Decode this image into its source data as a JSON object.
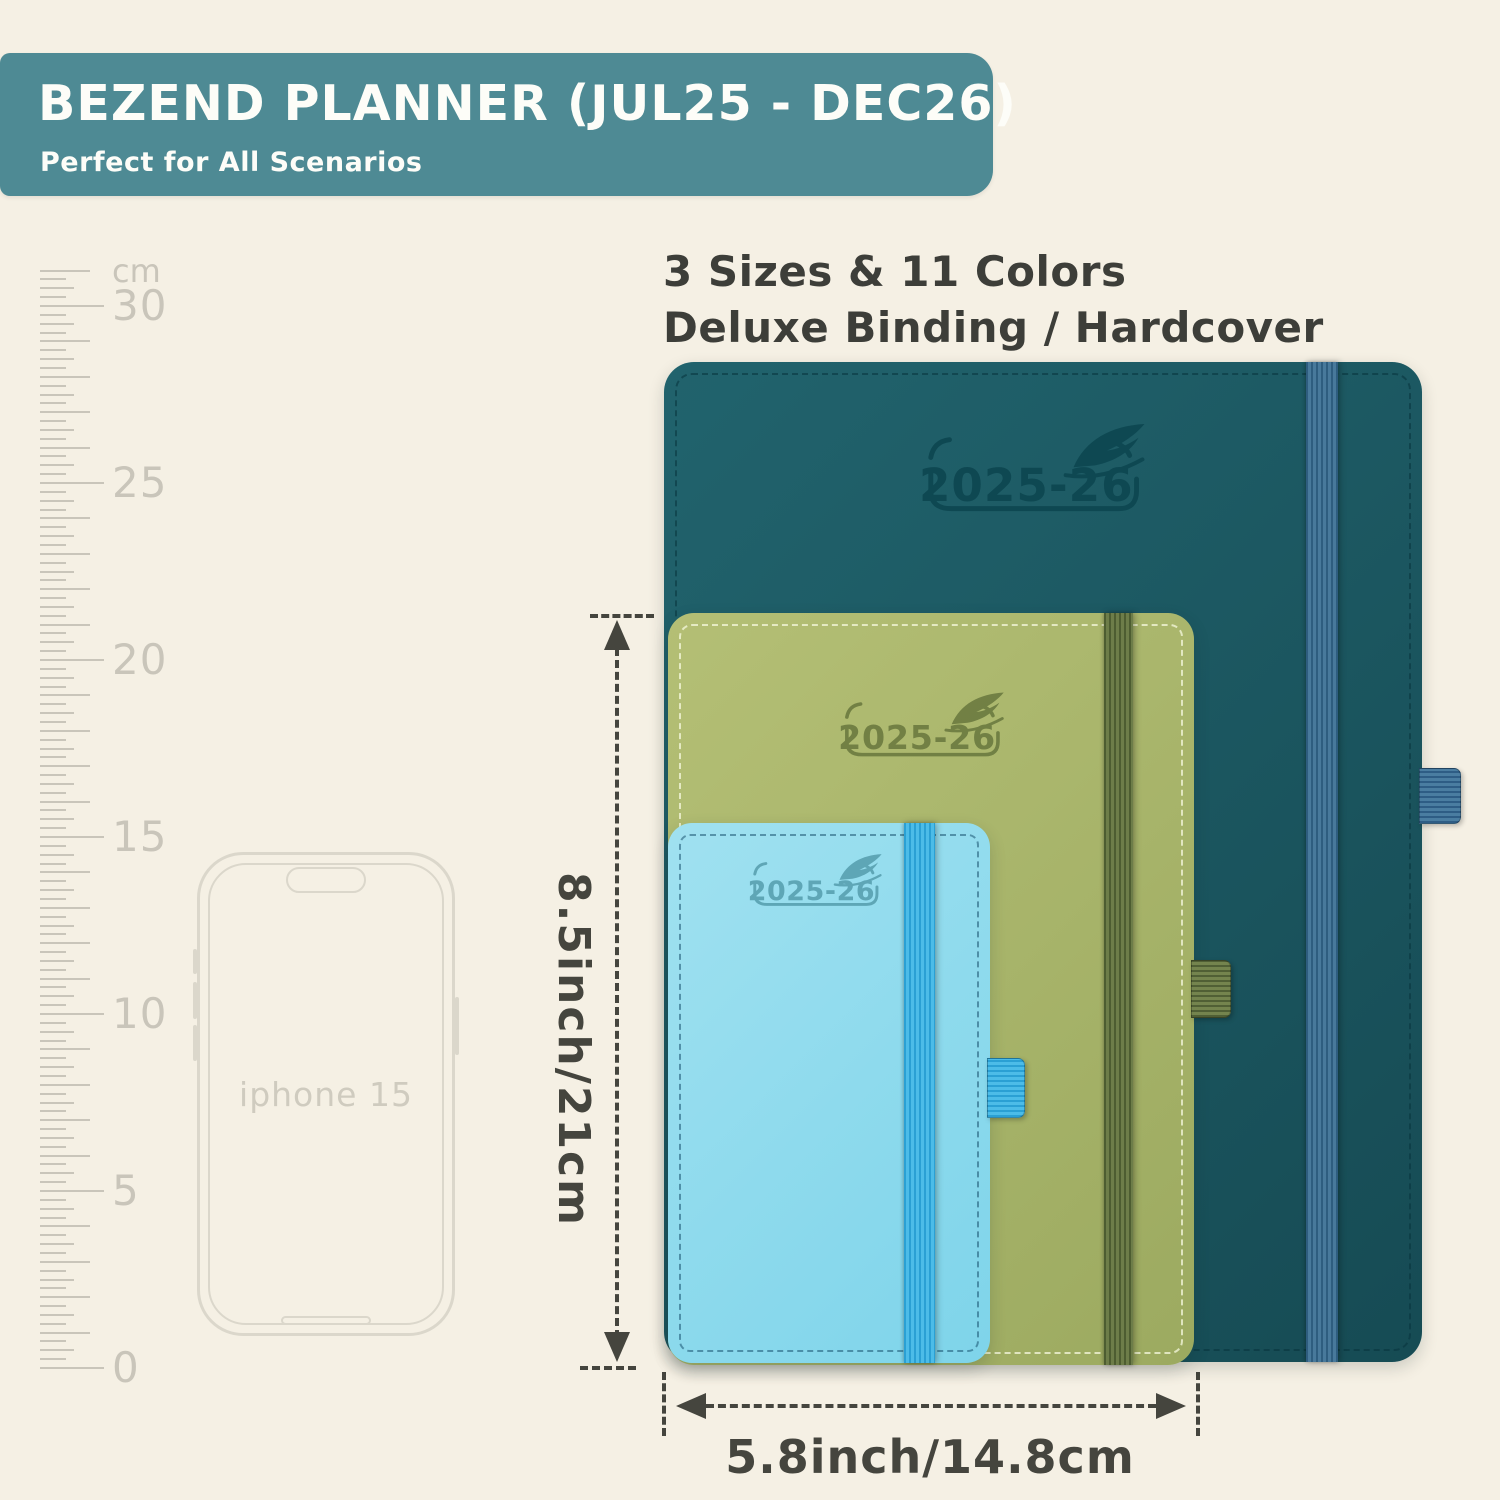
{
  "scene": {
    "background": "#f5f0e4"
  },
  "banner": {
    "title": "BEZEND PLANNER (JUL25 - DEC26)",
    "subtitle": "Perfect for All Scenarios",
    "bg": "#4e8a94",
    "text_color": "#fdfdf8"
  },
  "headline": {
    "line1": "3 Sizes & 11 Colors",
    "line2": "Deluxe Binding / Hardcover",
    "color": "#3d3e39"
  },
  "ruler": {
    "unit_label": "cm",
    "numbered_labels": [
      30,
      25,
      20,
      15,
      10,
      5,
      0
    ],
    "max_cm": 31,
    "px_per_cm": 35.4,
    "zero_y": 1368,
    "tick_x": 40,
    "color": "#c9c5ba"
  },
  "phone": {
    "label": "iphone 15",
    "outline_color": "#dbd7cb",
    "label_color": "#cfcbbf"
  },
  "logo": {
    "year_text": "2025-26"
  },
  "planners": [
    {
      "id": "planner-large-teal",
      "color_name": "dark teal",
      "x": 664,
      "y": 362,
      "w": 758,
      "h": 1000,
      "radius": 30,
      "cover": [
        "#21636d",
        "#164b54"
      ],
      "stitch": "rgba(8,52,60,0.55)",
      "band_x": 642,
      "band_w": 32,
      "band": [
        "#48799b",
        "#2e5d7f"
      ],
      "loop_y": 406,
      "loop_h": 54,
      "loop_w": 40,
      "loop": [
        "#4a7da1",
        "#2e5d85"
      ],
      "logo": {
        "x": 252,
        "y": 60,
        "w": 256,
        "color": "#0d4751"
      }
    },
    {
      "id": "planner-medium-green",
      "color_name": "olive green",
      "x": 668,
      "y": 613,
      "w": 526,
      "h": 752,
      "radius": 26,
      "cover": [
        "#b4bf75",
        "#9caa60"
      ],
      "stitch": "rgba(246,248,222,0.75)",
      "band_x": 436,
      "band_w": 29,
      "band": [
        "#6d7d49",
        "#4d5d31"
      ],
      "loop_y": 347,
      "loop_h": 56,
      "loop_w": 38,
      "loop": [
        "#74844e",
        "#505f35"
      ],
      "logo": {
        "x": 168,
        "y": 78,
        "w": 188,
        "color": "#6d7c41"
      }
    },
    {
      "id": "planner-small-blue",
      "color_name": "light blue",
      "x": 668,
      "y": 823,
      "w": 322,
      "h": 540,
      "radius": 24,
      "cover": [
        "#a0e1f0",
        "#7ed4ea"
      ],
      "stitch": "rgba(15,70,100,0.5)",
      "band_x": 236,
      "band_w": 31,
      "band": [
        "#4cbce8",
        "#2aa0d4"
      ],
      "loop_y": 235,
      "loop_h": 58,
      "loop_w": 36,
      "loop": [
        "#4cbce8",
        "#2aa0d4"
      ],
      "logo": {
        "x": 78,
        "y": 30,
        "w": 152,
        "color": "#5aa2b2"
      }
    }
  ],
  "dimensions": {
    "color": "#45453e",
    "height": {
      "label": "8.5inch/21cm"
    },
    "width": {
      "label": "5.8inch/14.8cm"
    }
  }
}
